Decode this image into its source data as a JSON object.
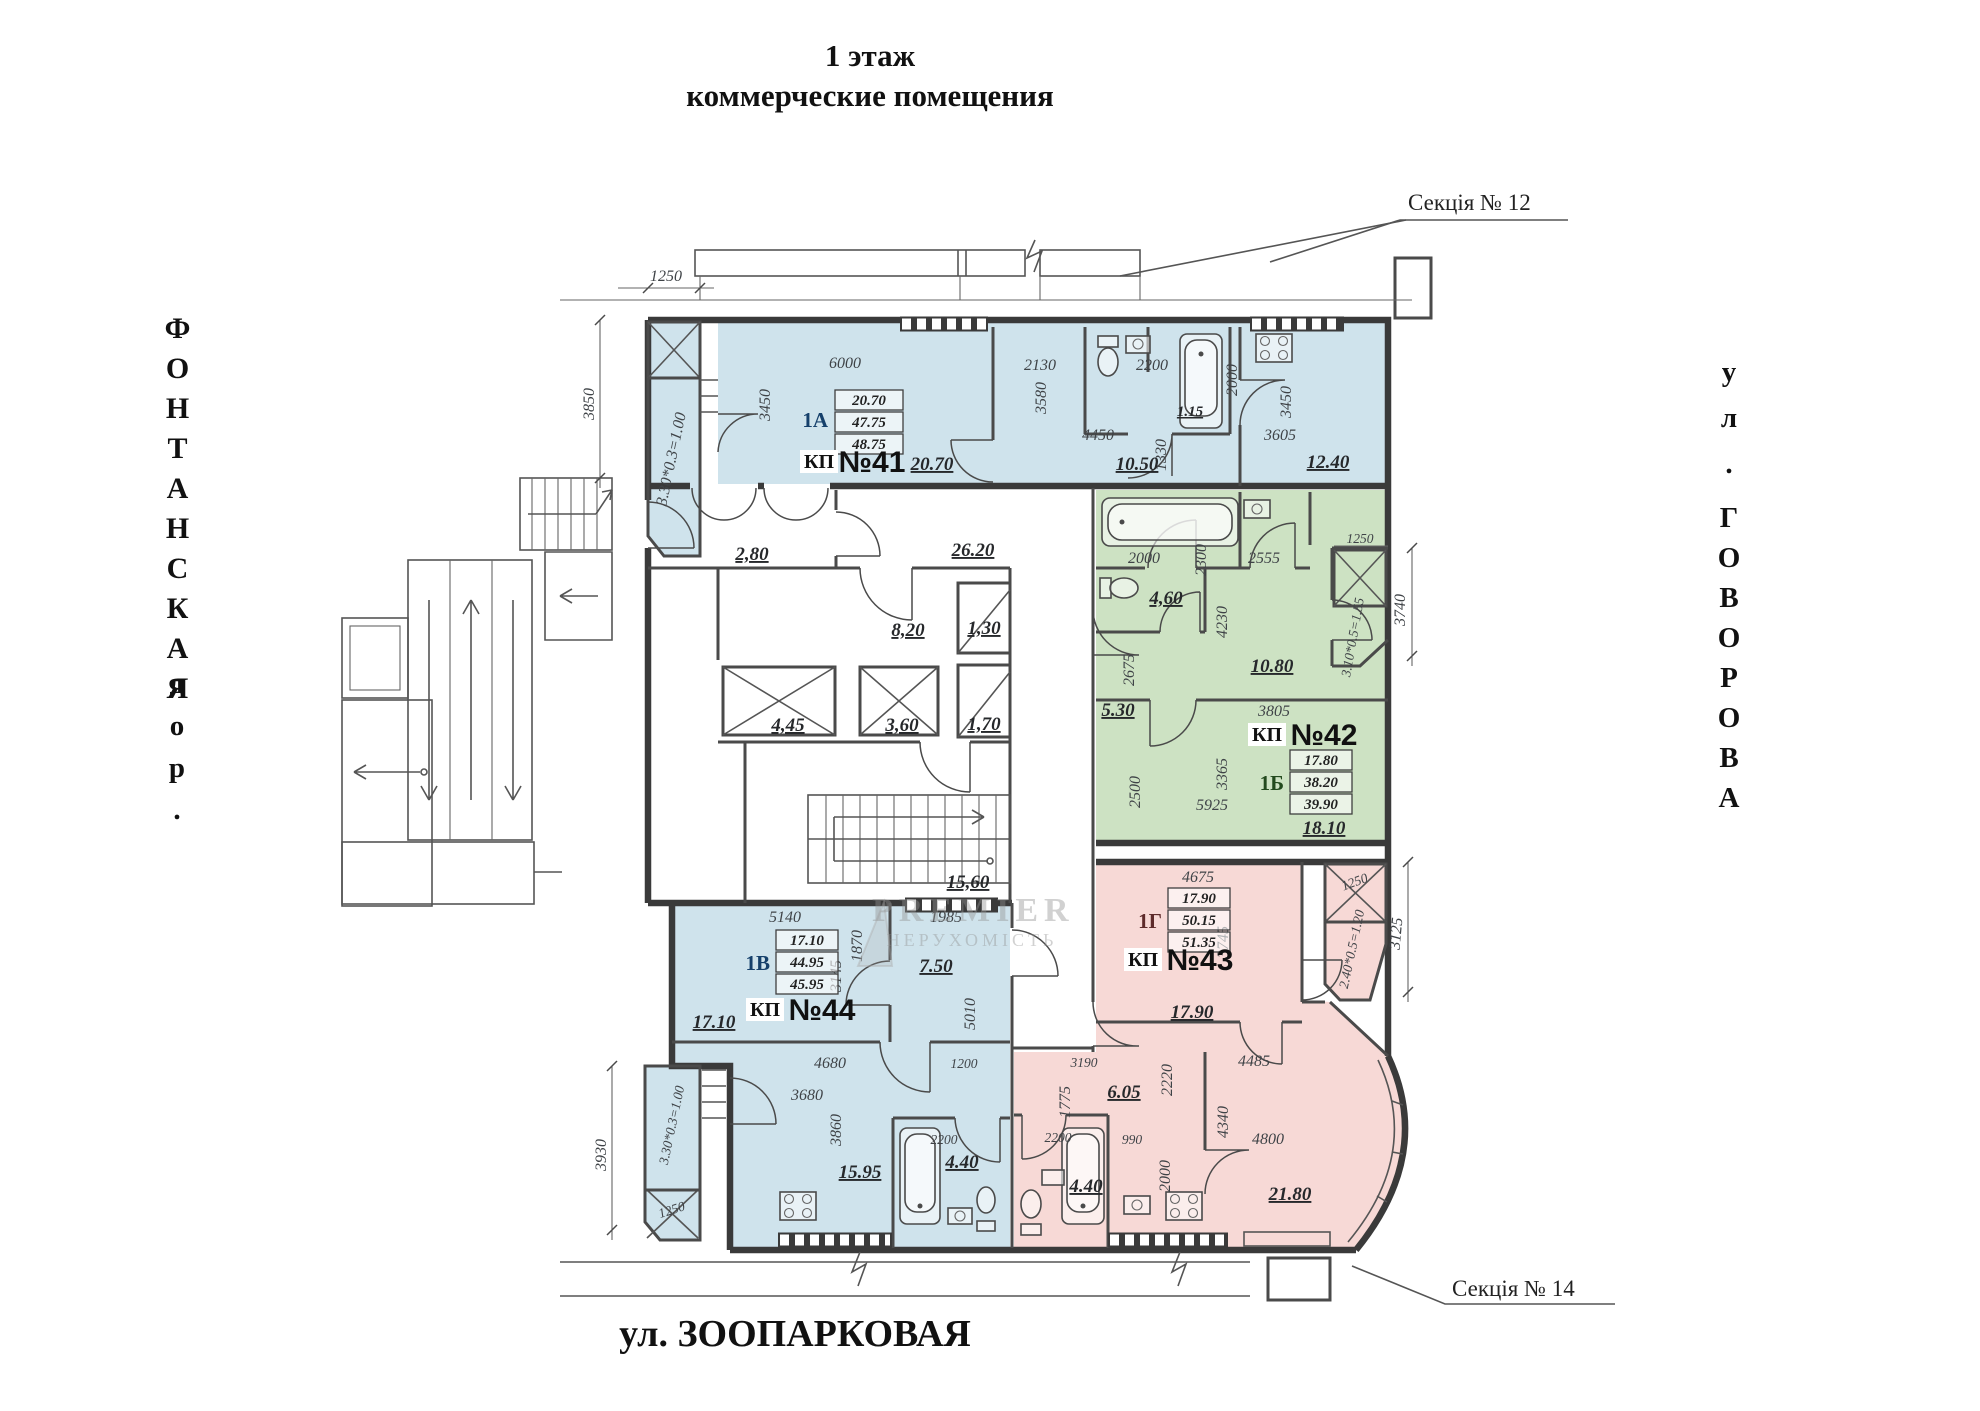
{
  "page": {
    "title_line1": "1 этаж",
    "title_line2": "коммерческие помещения"
  },
  "streets": {
    "left_name": "ФОНТАНСКАЯ",
    "left_type": "дор.",
    "right_type": "ул.",
    "right_name": "ГОВОРОВА",
    "bottom": "ул. ЗООПАРКОВАЯ"
  },
  "callouts": {
    "section_top": "Секція № 12",
    "section_bottom": "Секція № 14"
  },
  "watermark": {
    "brand": "PREMIER",
    "sub": "НЕРУХОМІСТЬ"
  },
  "colors": {
    "unit_blue": "#cfe3ec",
    "unit_green": "#cde2c3",
    "unit_pink": "#f7d9d6"
  },
  "core": {
    "tambour": "2,80",
    "corridor": "26.20",
    "lobby": "8,20",
    "shaft_a": "1,30",
    "shaft_b": "1,70",
    "lift_a": "4,45",
    "lift_b": "3,60",
    "stairs": "15,60"
  },
  "units": {
    "kp41": {
      "kp": "КП",
      "num": "№41",
      "code": "1А",
      "table": [
        "20.70",
        "47.75",
        "48.75"
      ],
      "area_main": "20.70",
      "area_hall": "10.50",
      "area_bath": "1.15",
      "area_kitchen": "12.40"
    },
    "kp42": {
      "kp": "КП",
      "num": "№42",
      "code": "1Б",
      "table": [
        "17.80",
        "38.20",
        "39.90"
      ],
      "area_bath": "4,60",
      "area_hall": "10.80",
      "area_corr": "5.30",
      "area_room": "18.10"
    },
    "kp43": {
      "kp": "КП",
      "num": "№43",
      "code": "1Г",
      "table": [
        "17.90",
        "50.15",
        "51.35"
      ],
      "area_room1": "17.90",
      "area_corr": "6.05",
      "area_bath": "4.40",
      "area_room2": "21.80"
    },
    "kp44": {
      "kp": "КП",
      "num": "№44",
      "code": "1В",
      "table": [
        "17.10",
        "44.95",
        "45.95"
      ],
      "area_room1": "17.10",
      "area_hall": "7.50",
      "area_kitchen": "15.95",
      "area_bath": "4.40"
    }
  },
  "dims": {
    "a1250": "1250",
    "a3850": "3850",
    "a_shaft41": "3.30*0.3=1.00",
    "a3450L": "3450",
    "a6000": "6000",
    "a2130": "2130",
    "a3580": "3580",
    "a2200": "2200",
    "a2000": "2000",
    "a3450R": "3450",
    "a4450": "4450",
    "a1330": "1330",
    "a3605": "3605",
    "b2000": "2000",
    "b2300": "2300",
    "b2555": "2555",
    "b4230": "4230",
    "b2675": "2675",
    "b3805": "3805",
    "b3365": "3365",
    "b2500": "2500",
    "b5925": "5925",
    "b1250": "1250",
    "b_shaft42": "3.10*0.5=1.55",
    "b3740": "3740",
    "c4675": "4675",
    "c3745": "3745",
    "c1250": "1250",
    "c_shaft43": "2.40*0.5=1.20",
    "c3125": "3125",
    "c4485": "4485",
    "c2220": "2220",
    "c4340": "4340",
    "c4800": "4800",
    "c3190": "3190",
    "c1775": "1775",
    "c2200": "2200",
    "c990": "990",
    "c2000": "2000",
    "d5140": "5140",
    "d1985": "1985",
    "d1870": "1870",
    "d3145": "3145",
    "d5010": "5010",
    "d4680": "4680",
    "d1200": "1200",
    "d3680": "3680",
    "d3860": "3860",
    "d2200": "2200",
    "d3930": "3930",
    "d1250": "1250",
    "d_shaft44": "3.30*0.3=1.00"
  }
}
